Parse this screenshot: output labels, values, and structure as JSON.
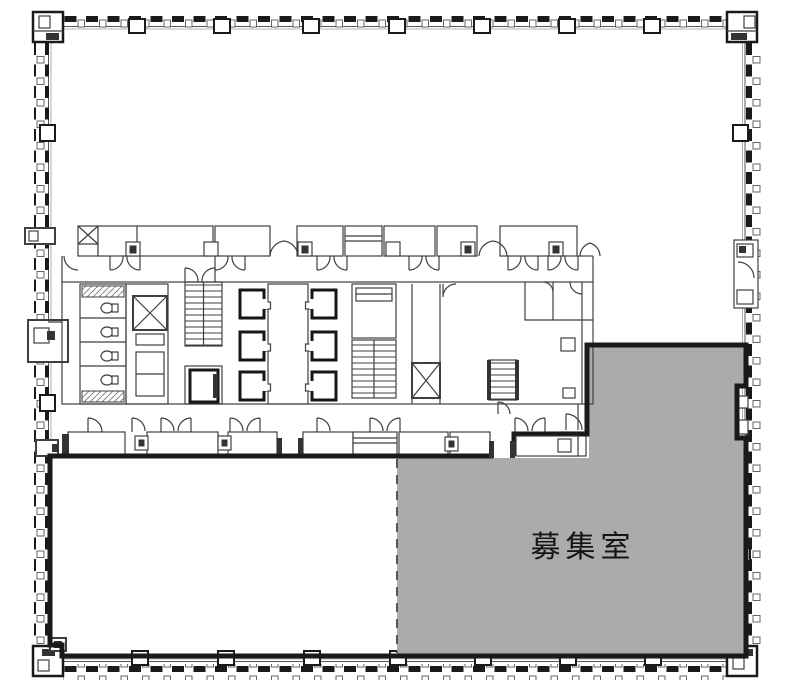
{
  "floor_plan": {
    "vacancy_label": "募集室",
    "colors": {
      "wall": "#1a1a1a",
      "line": "#3f3f3f",
      "vacant_fill": "#ababab",
      "background": "#ffffff"
    }
  }
}
